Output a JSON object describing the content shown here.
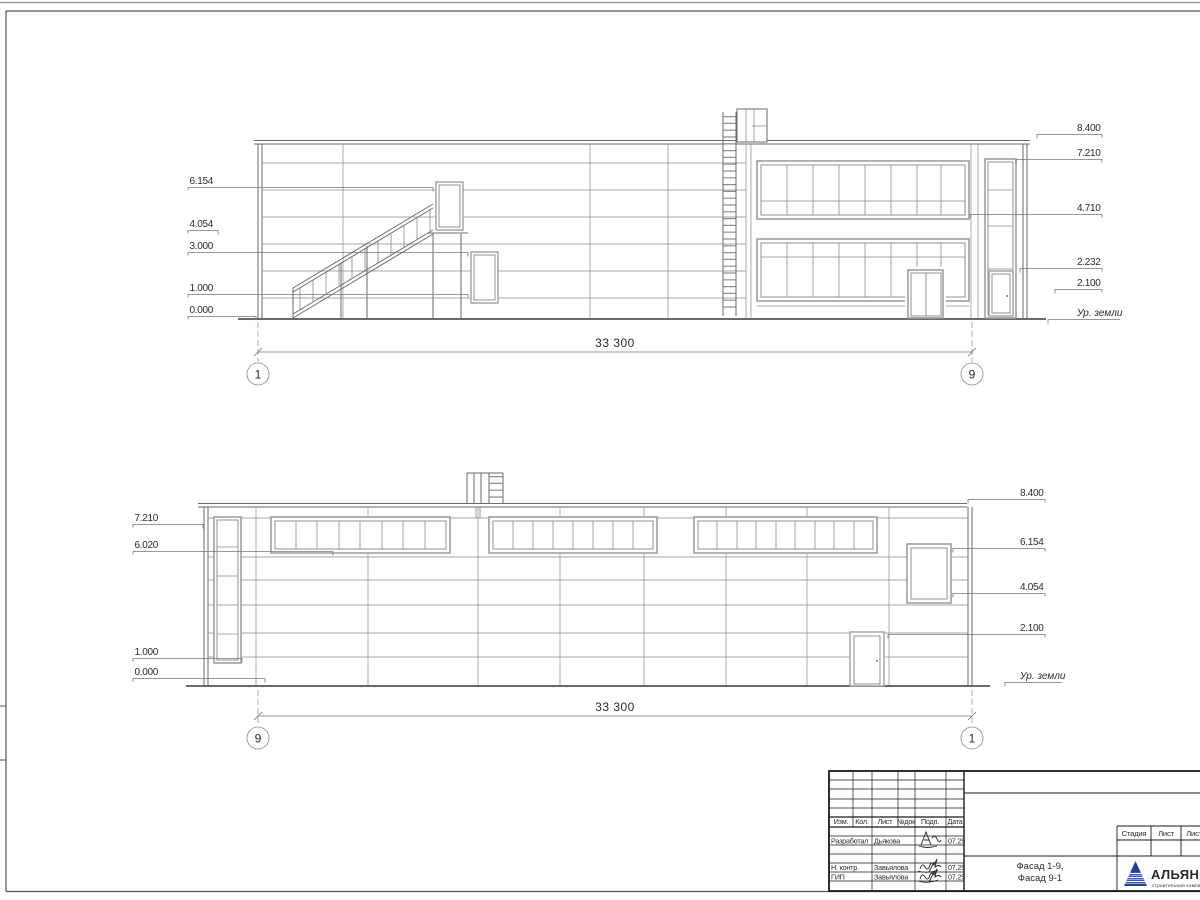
{
  "sheet": {
    "type": "Архитектурный чертёж — фасады",
    "line_color": "#6a6a6a",
    "frame_color": "#555555"
  },
  "facade_19": {
    "dim": "33 300",
    "axis_left": "1",
    "axis_right": "9",
    "elev_left": [
      "6.154",
      "4.054",
      "3.000",
      "1.000",
      "0.000"
    ],
    "elev_right": [
      "8.400",
      "7.210",
      "4.710",
      "2.232",
      "2.100"
    ],
    "ground": "Ур. земли"
  },
  "facade_91": {
    "dim": "33 300",
    "axis_left": "9",
    "axis_right": "1",
    "elev_left": [
      "7.210",
      "6.020",
      "1.000",
      "0.000"
    ],
    "elev_right": [
      "8.400",
      "6.154",
      "4.054",
      "2.100"
    ],
    "ground": "Ур. земли"
  },
  "titleblock": {
    "cols": [
      "Изм.",
      "Кол.",
      "Лист",
      "№док",
      "Подп.",
      "Дата"
    ],
    "rows": [
      {
        "role": "Разработал",
        "name": "Дьякова",
        "date": "07.25"
      },
      {
        "role": "Н. контр.",
        "name": "Завьялова",
        "date": "07.25"
      },
      {
        "role": "ГИП",
        "name": "Завьялова",
        "date": "07.25"
      }
    ],
    "title_line1": "Фасад 1-9,",
    "title_line2": "Фасад 9-1",
    "stage_cols": [
      "Стадия",
      "Лист",
      "Листов"
    ],
    "logo_name": "АЛЬЯНС",
    "logo_tagline": "строительная компания",
    "logo_blue": "#24408e",
    "logo_light_blue": "#7fb2e0",
    "logo_red": "#c2443a"
  }
}
